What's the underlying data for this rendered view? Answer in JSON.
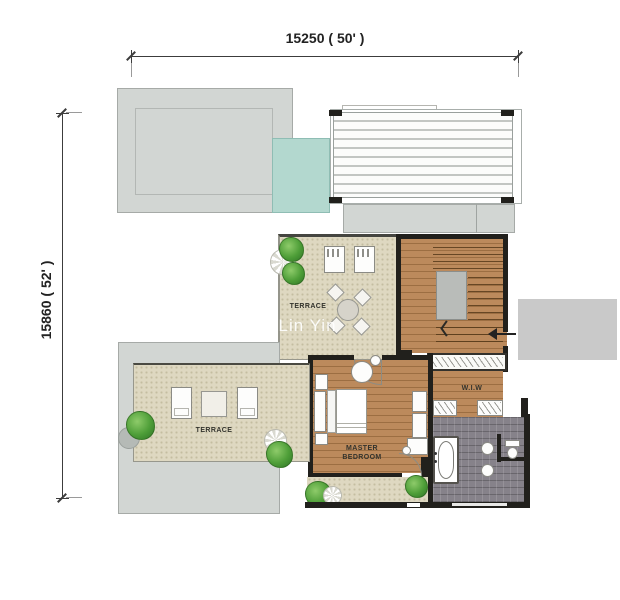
{
  "dimensions": {
    "top": "15250 ( 50' )",
    "left": "15860 ( 52' )"
  },
  "rooms": {
    "terrace_upper": "TERRACE",
    "terrace_lower": "TERRACE",
    "master_bedroom_line1": "MASTER",
    "master_bedroom_line2": "BEDROOM",
    "wiw": "W.I.W"
  },
  "watermark": "i Lin Yin",
  "colors": {
    "wall": "#21201c",
    "slab": "#d2d6d3",
    "slab_border": "#a6aaa7",
    "pool": "#b3d8cf",
    "pool_border": "#8fbdb4",
    "terrace": "#ded8c1",
    "wood": "#bc8a5c",
    "wood_line": "#9c6e42",
    "tile": "#86828a",
    "tree": "#4e9e38",
    "watermark_block": "#c9c9c9",
    "label_text": "#33332d",
    "dim_text": "#222222"
  }
}
